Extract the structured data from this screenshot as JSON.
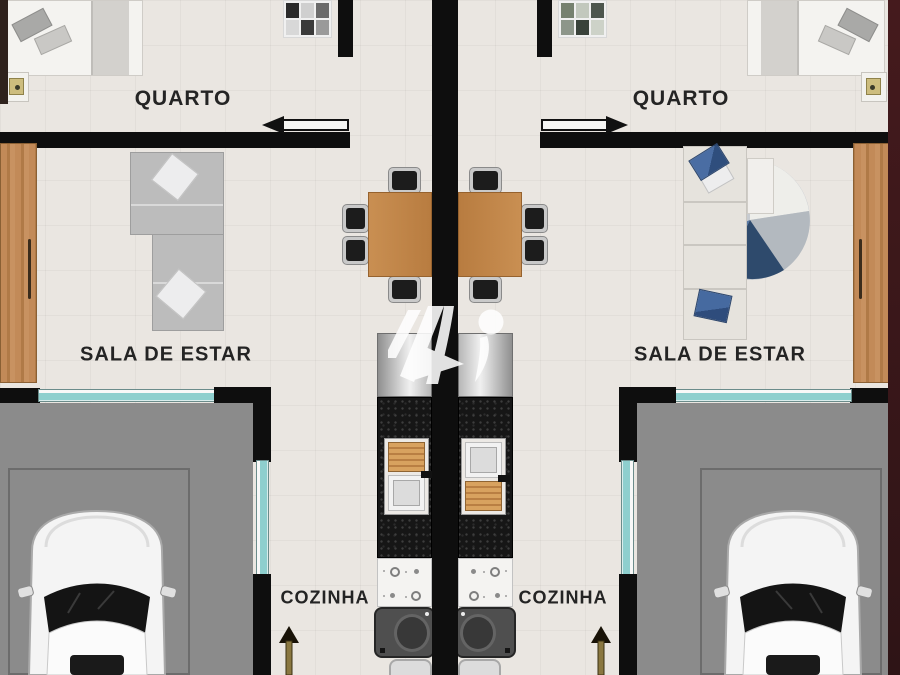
{
  "plan": {
    "type": "floor-plan",
    "description": "Top-view architectural floor plan of two mirrored twin residential units with garages",
    "left_unit": {
      "bedroom_label": "QUARTO",
      "living_room_label": "SALA DE ESTAR",
      "kitchen_label": "COZINHA",
      "furniture": [
        "bed",
        "nightstand-lamp",
        "wardrobe",
        "l-shaped-sofa",
        "dining-table-4-chairs",
        "fridge",
        "sink-counter",
        "stove-cooktop",
        "laundry-tank",
        "car-in-garage"
      ]
    },
    "right_unit": {
      "bedroom_label": "QUARTO",
      "living_room_label": "SALA DE ESTAR",
      "kitchen_label": "COZINHA",
      "furniture": [
        "bed",
        "nightstand-lamp",
        "wardrobe",
        "sofa-with-blue-pillows",
        "round-rug",
        "dining-table-4-chairs",
        "fridge",
        "sink-counter",
        "stove-cooktop",
        "laundry-tank",
        "car-in-garage"
      ]
    },
    "watermark": "logo-watermark",
    "colors": {
      "floor": "#eae6e1",
      "wall": "#0e0e0e",
      "table_wood": "#c08046",
      "door_wood": "#c28a58",
      "garage_floor": "#8b8b8b",
      "window_glass": "#8ecfce",
      "counter_granite": "#161616",
      "accent_blue": "#4a6da3",
      "rug_navy": "#2e4a6c",
      "label_text": "#242424",
      "right_border": "#3b181a"
    }
  }
}
